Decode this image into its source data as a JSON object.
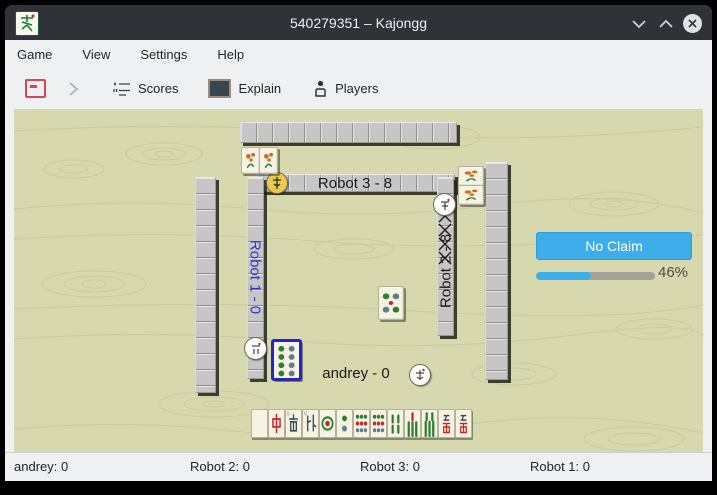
{
  "window": {
    "title": "540279351 – Kajongg",
    "controls": {
      "minimize": "v",
      "maximize": "^",
      "close": "x"
    }
  },
  "menu": {
    "items": [
      {
        "label": "Game"
      },
      {
        "label": "View"
      },
      {
        "label": "Settings"
      },
      {
        "label": "Help"
      }
    ]
  },
  "toolbar": {
    "scores_label": "Scores",
    "explain_label": "Explain",
    "players_label": "Players"
  },
  "board": {
    "top_player": {
      "label": "Robot 3 - 8",
      "wind_disc": "yellow"
    },
    "left_player": {
      "label": "Robot 1 - 0",
      "color": "#3232cd",
      "wind_disc": "white"
    },
    "right_player": {
      "label": "Robot 2 - 8",
      "wind_disc": "white"
    },
    "bottom_player": {
      "label": "andrey - 0",
      "wind_disc": "white"
    },
    "center_tile": {
      "kind": "circle-5"
    },
    "focused_tile": {
      "kind": "circle-8"
    },
    "bonus_tiles_top": [
      "bonus",
      "bonus"
    ],
    "bonus_tiles_right": [
      "bonus",
      "bonus"
    ],
    "hand": {
      "tiles": [
        "blank",
        "dragon-red",
        "wind-south",
        "wind-north",
        "circle-1",
        "circle-2",
        "circle-9",
        "circle-9",
        "bamboo-4",
        "bamboo-7",
        "bamboo-8",
        "char-5",
        "char-9"
      ]
    },
    "walls": {
      "right_inner_crossed": 4
    }
  },
  "claim": {
    "button_label": "No Claim",
    "progress_percent": 46,
    "progress_label": "46%"
  },
  "statusbar": {
    "items": [
      {
        "label": "andrey: 0"
      },
      {
        "label": "Robot 2: 0"
      },
      {
        "label": "Robot 3: 0"
      },
      {
        "label": "Robot 1: 0"
      }
    ]
  },
  "colors": {
    "accent": "#3daee9",
    "titlebar": "#2f3338",
    "table": "#d8d8ae"
  }
}
